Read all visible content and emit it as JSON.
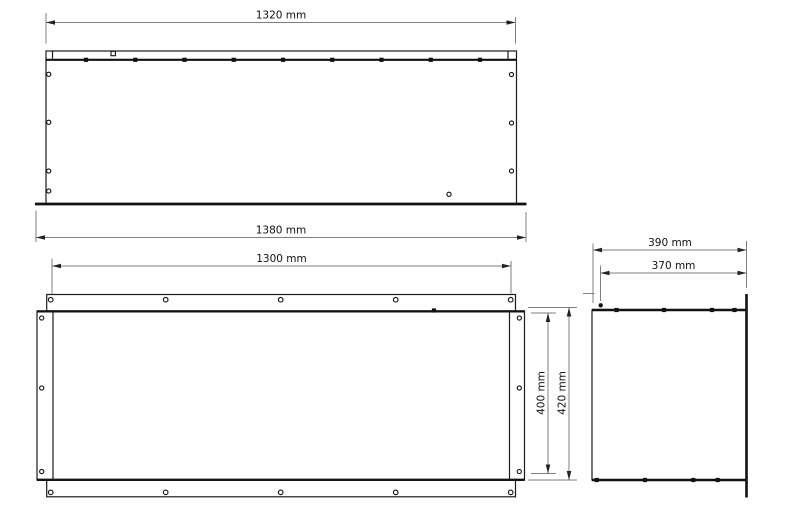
{
  "drawing": {
    "unit": "mm",
    "colors": {
      "line": "#1a1a1a",
      "dimension_line": "#7f7f7f",
      "text": "#111111",
      "background": "#ffffff"
    },
    "views": {
      "front": {
        "dims": {
          "top_width": {
            "label": "1320 mm",
            "value": 1320
          },
          "base_width": {
            "label": "1380 mm",
            "value": 1380
          }
        },
        "features": {
          "top_fastener_count": 9,
          "left_hole_count": 4,
          "right_hole_count": 3
        }
      },
      "back": {
        "dims": {
          "flange_hole_span": {
            "label": "1300 mm",
            "value": 1300
          },
          "body_height": {
            "label": "400 mm",
            "value": 400
          },
          "overall_height": {
            "label": "420 mm",
            "value": 420
          }
        },
        "features": {
          "flange_hole_count_per_strip": 5,
          "side_hole_count_per_side": 3
        }
      },
      "side": {
        "dims": {
          "overall_depth": {
            "label": "390 mm",
            "value": 390
          },
          "inner_depth": {
            "label": "370 mm",
            "value": 370
          }
        },
        "features": {
          "top_fastener_count": 4,
          "bottom_fastener_count": 4
        }
      }
    }
  }
}
